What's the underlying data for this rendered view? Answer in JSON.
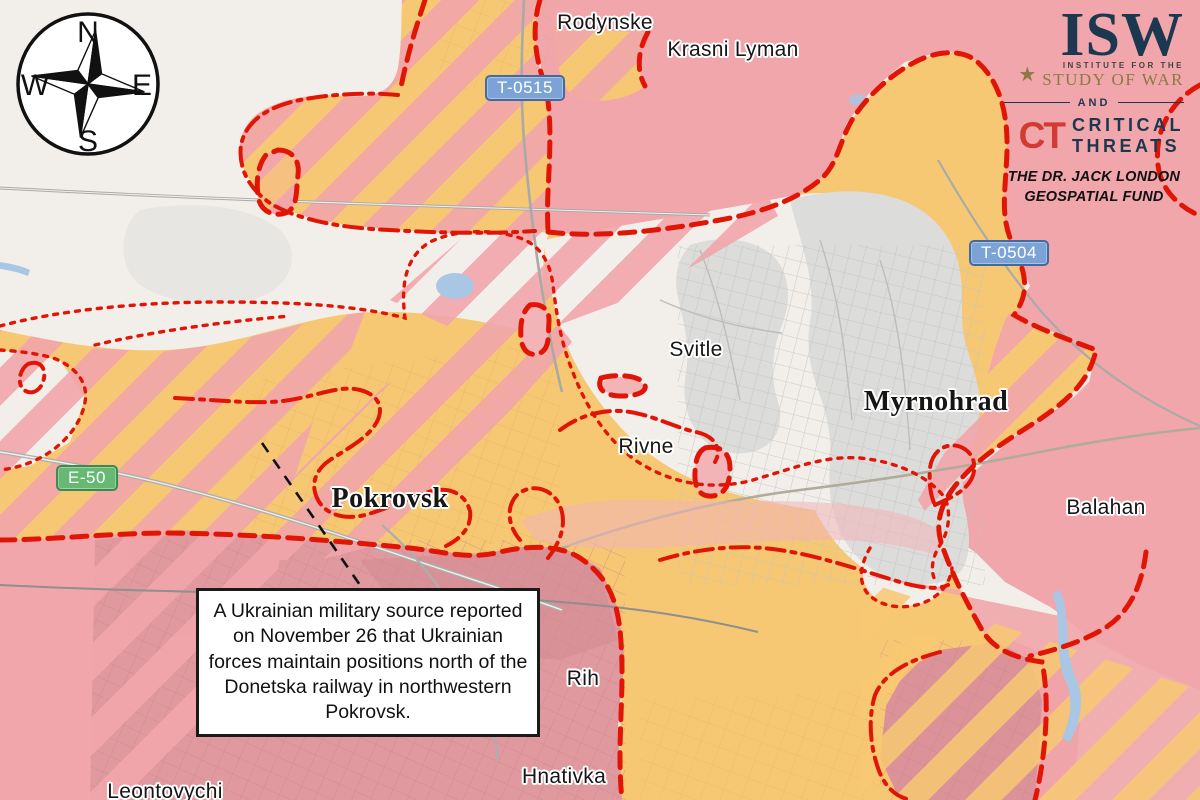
{
  "title": "Pokrovsk area assessed control of terrain map",
  "compass": {
    "n": "N",
    "e": "E",
    "s": "S",
    "w": "W"
  },
  "logo": {
    "isw": "ISW",
    "star": "★",
    "institute": "INSTITUTE FOR THE",
    "study_of_war": "STUDY OF WAR",
    "and": "AND",
    "ct": "CT",
    "critical": "CRITICAL",
    "threats": "THREATS",
    "fund_line1": "THE DR. JACK LONDON",
    "fund_line2": "GEOSPATIAL FUND"
  },
  "roads": [
    {
      "id": "t0515",
      "label": "T-0515",
      "type": "blue"
    },
    {
      "id": "t0504",
      "label": "T-0504",
      "type": "blue"
    },
    {
      "id": "e50",
      "label": "E-50",
      "type": "green"
    }
  ],
  "towns": [
    {
      "label": "Rodynske"
    },
    {
      "label": "Krasni Lyman"
    },
    {
      "label": "Svitle"
    },
    {
      "label": "Rivne"
    },
    {
      "label": "Balahan"
    },
    {
      "label": "Rih"
    },
    {
      "label": "Hnativka"
    },
    {
      "label": "Leontovychi"
    }
  ],
  "cities": [
    {
      "label": "Pokrovsk"
    },
    {
      "label": "Myrnohrad"
    }
  ],
  "annotation": {
    "text": "A Ukrainian military source reported on November 26 that Ukrainian forces maintain positions north of the Donetska railway in northwestern Pokrovsk."
  },
  "colors": {
    "paper": "#f2efeb",
    "russian_claimed_pink": "#f1a6ab",
    "assessed_advance_orange": "#f7c873",
    "urban_controlled_dark_pink": "#e09a9f",
    "urban_gray": "#dcdcda",
    "boundary_red": "#e11505",
    "water_blue": "#a9c7e4",
    "shield_blue": "#7ca3d6",
    "shield_green": "#66b873",
    "logo_navy": "#1c3750",
    "logo_gold": "#8c7845",
    "logo_red": "#d23b33"
  }
}
